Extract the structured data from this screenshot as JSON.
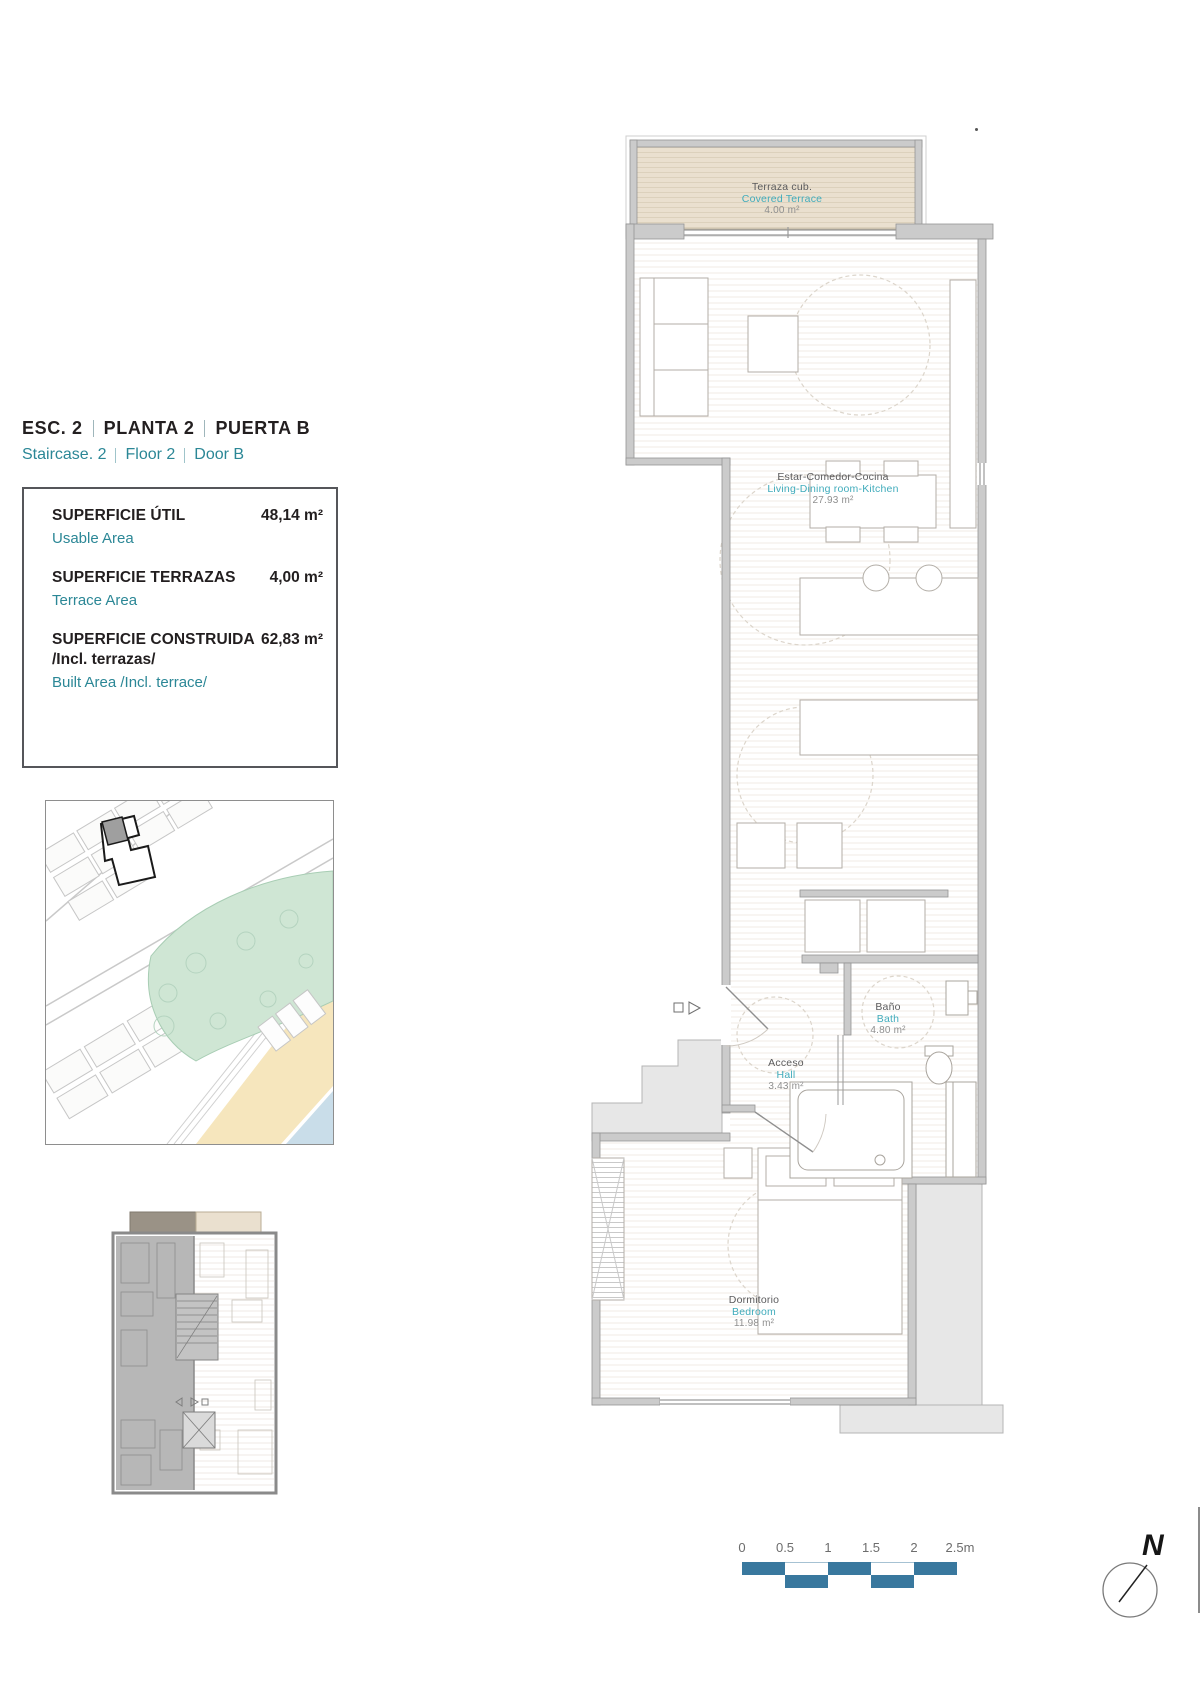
{
  "header": {
    "title_parts": [
      "ESC.  2",
      "PLANTA   2",
      "PUERTA  B"
    ],
    "subtitle_parts": [
      "Staircase.  2",
      "Floor   2",
      "Door  B"
    ]
  },
  "area_summary": {
    "rows": [
      {
        "label_es": "SUPERFICIE ÚTIL",
        "label_es_note": "",
        "label_en": "Usable Area",
        "value": "48,14 m²"
      },
      {
        "label_es": "SUPERFICIE TERRAZAS",
        "label_es_note": "",
        "label_en": "Terrace Area",
        "value": "4,00 m²"
      },
      {
        "label_es": "SUPERFICIE CONSTRUIDA",
        "label_es_note": "/Incl. terrazas/",
        "label_en": "Built Area /Incl. terrace/",
        "value": "62,83 m²"
      }
    ]
  },
  "rooms": {
    "covered_terrace": {
      "name_es": "Terraza cub.",
      "name_en": "Covered Terrace",
      "area": "4.00 m²"
    },
    "living": {
      "name_es": "Estar-Comedor-Cocina",
      "name_en": "Living-Dining room-Kitchen",
      "area": "27.93 m²"
    },
    "bath": {
      "name_es": "Baño",
      "name_en": "Bath",
      "area": "4.80 m²"
    },
    "hall": {
      "name_es": "Acceso",
      "name_en": "Hall",
      "area": "3.43 m²"
    },
    "bedroom": {
      "name_es": "Dormitorio",
      "name_en": "Bedroom",
      "area": "11.98 m²"
    }
  },
  "scale_bar": {
    "labels": [
      "0",
      "0.5",
      "1",
      "1.5",
      "2",
      "2.5m"
    ]
  },
  "compass": {
    "label": "N"
  },
  "colors": {
    "teal": "#2b8796",
    "label_teal": "#41acbc",
    "scalebar": "#39789e",
    "terrace_fill": "#eae0cf",
    "park": "#cfe6d4",
    "sand": "#f6e6bd",
    "water": "#c9dde9"
  }
}
